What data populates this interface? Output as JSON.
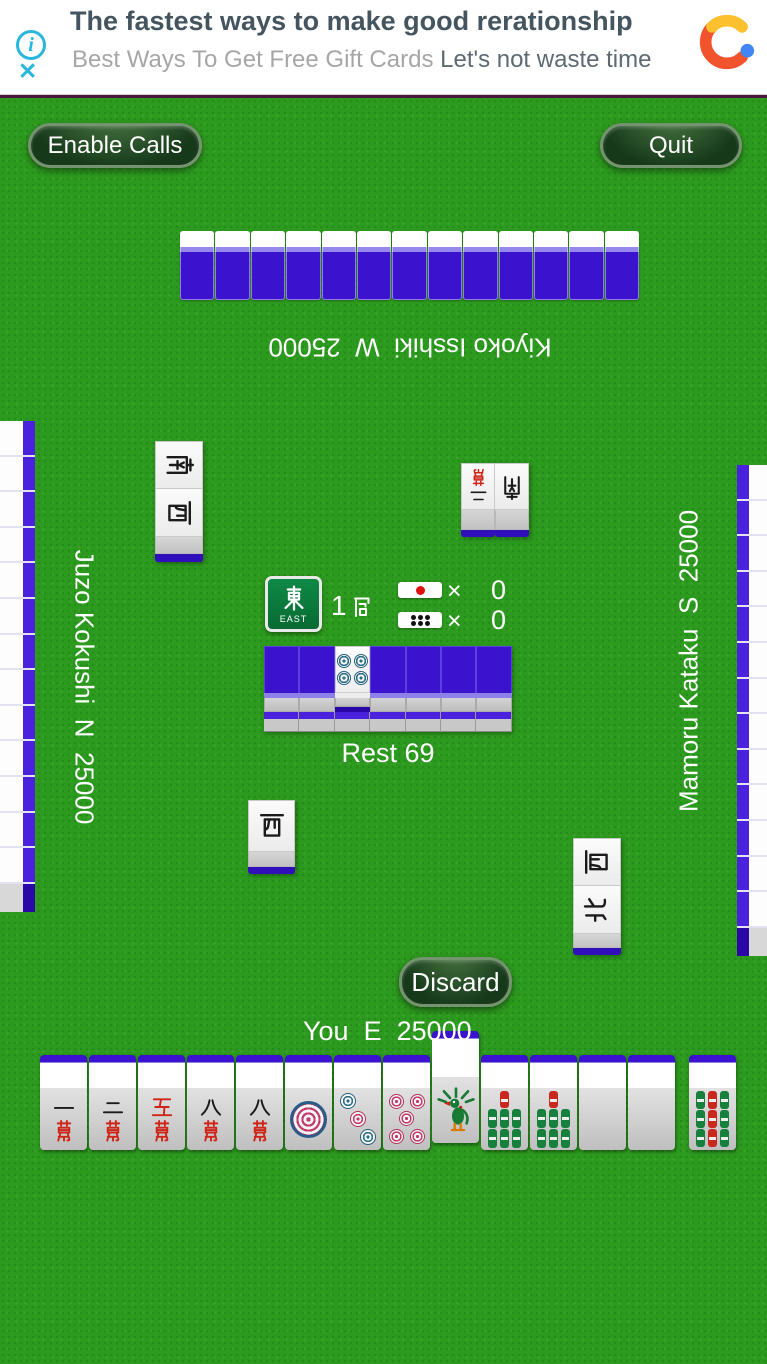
{
  "ad_banner": {
    "title": "The fastest ways to make good rerationship",
    "subtitle": "Best Ways To Get Free Gift Cards",
    "subtitle_cta": "Let's not waste time",
    "info_icon": "i",
    "close_icon": "✕",
    "accent_color": "#2ab7dc"
  },
  "toolbar": {
    "enable_calls_label": "Enable Calls",
    "quit_label": "Quit"
  },
  "players": {
    "top": {
      "name": "Kiyoko Isshiki",
      "wind": "W",
      "score": 25000,
      "display": "Kiyoko Isshiki  W  25000",
      "hidden_tiles": 13
    },
    "left": {
      "name": "Juzo Kokushi",
      "wind": "N",
      "score": 25000,
      "display": "Juzo Kokushi  N  25000"
    },
    "right": {
      "name": "Mamoru Kataku",
      "wind": "S",
      "score": 25000,
      "display": "Mamoru Kataku  S  25000"
    },
    "you": {
      "name": "You",
      "wind": "E",
      "score": 25000,
      "display": "You  E  25000"
    }
  },
  "center": {
    "round_wind_kanji": "東",
    "round_wind_label": "EAST",
    "hand_number": "1",
    "hand_kanji": "局",
    "hand_label": "1局",
    "times": "×",
    "riichi_count": "0",
    "honba_count": "0",
    "rest_label": "Rest 69",
    "rest_count": 69,
    "dead_wall_columns": 7,
    "dora_indicator_tile": "4-pin"
  },
  "walls": {
    "left_segments": 13,
    "right_segments": 13
  },
  "discards": {
    "top": [
      {
        "tile": "2-man",
        "kanji": "二萬"
      },
      {
        "tile": "South wind",
        "kanji": "南"
      }
    ],
    "left": [
      {
        "tile": "South wind",
        "kanji": "南"
      },
      {
        "tile": "West wind",
        "kanji": "西"
      }
    ],
    "right": [
      {
        "tile": "West wind",
        "kanji": "西"
      },
      {
        "tile": "North wind",
        "kanji": "北"
      }
    ],
    "you": [
      {
        "tile": "West wind",
        "kanji": "西"
      }
    ]
  },
  "action": {
    "discard_label": "Discard"
  },
  "hand": {
    "tiles": [
      {
        "tile": "1-man",
        "kanji": "一萬"
      },
      {
        "tile": "2-man",
        "kanji": "二萬"
      },
      {
        "tile": "5-man (red)",
        "kanji": "五萬"
      },
      {
        "tile": "8-man",
        "kanji": "八萬"
      },
      {
        "tile": "8-man",
        "kanji": "八萬"
      },
      {
        "tile": "1-pin"
      },
      {
        "tile": "3-pin"
      },
      {
        "tile": "5-pin"
      },
      {
        "tile": "1-sou",
        "raised": true
      },
      {
        "tile": "7-sou"
      },
      {
        "tile": "7-sou"
      },
      {
        "tile": "White Dragon"
      },
      {
        "tile": "White Dragon"
      }
    ],
    "drawn_tile": {
      "tile": "9-sou"
    }
  },
  "colors": {
    "felt": "#2c9a1e",
    "tile_back": "#3b13ce",
    "tile_back_dark": "#2a08a8",
    "button_green": "#16391a"
  }
}
